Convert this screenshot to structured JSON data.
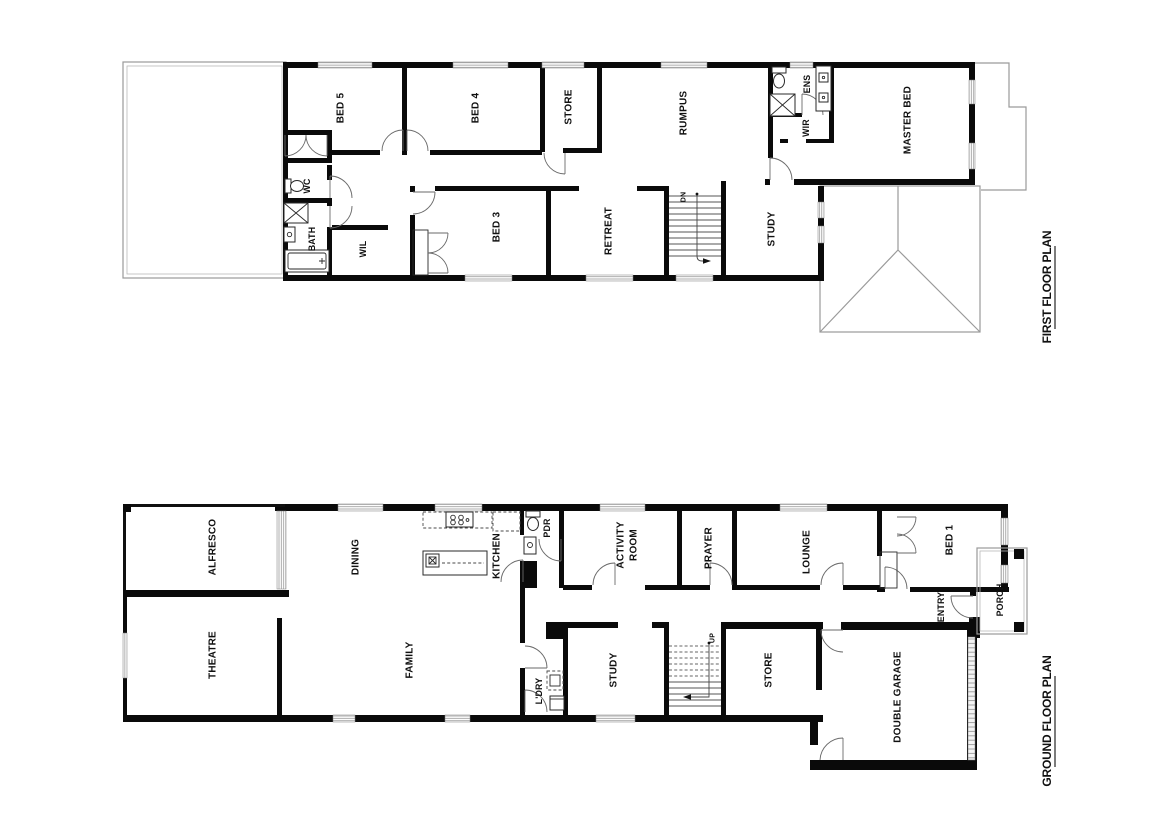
{
  "drawing": {
    "background": "#ffffff",
    "wall_color": "#0a0a0a",
    "roof_outline_color": "#9a9a9a"
  },
  "first_floor": {
    "title": "FIRST FLOOR PLAN",
    "stairs": "DN",
    "rooms": {
      "bed5": "BED 5",
      "bed4": "BED 4",
      "store": "STORE",
      "rumpus": "RUMPUS",
      "ens": "ENS",
      "wir": "WIR",
      "master_bed": "MASTER BED",
      "wc": "WC",
      "bath": "BATH",
      "wil": "WIL",
      "bed3": "BED 3",
      "retreat": "RETREAT",
      "study": "STUDY"
    }
  },
  "ground_floor": {
    "title": "GROUND FLOOR PLAN",
    "stairs": "UP",
    "rooms": {
      "alfresco": "ALFRESCO",
      "dining": "DINING",
      "kitchen": "KITCHEN",
      "pdr": "PDR",
      "activity_line1": "ACTIVITY",
      "activity_line2": "ROOM",
      "prayer": "PRAYER",
      "lounge": "LOUNGE",
      "bed1": "BED 1",
      "theatre": "THEATRE",
      "family": "FAMILY",
      "ldry": "L'DRY",
      "study": "STUDY",
      "store": "STORE",
      "entry": "ENTRY",
      "porch": "PORCH",
      "double_garage": "DOUBLE GARAGE"
    }
  }
}
